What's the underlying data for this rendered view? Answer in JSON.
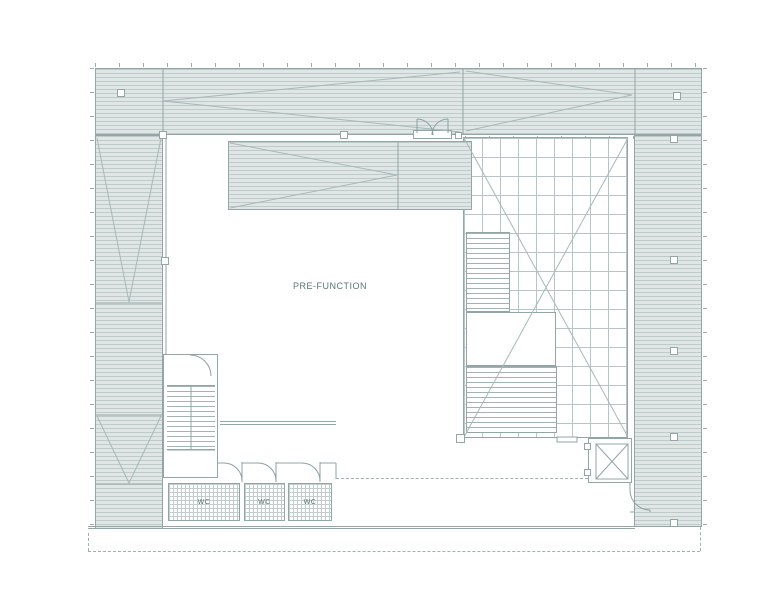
{
  "plan": {
    "type": "architectural-floor-plan",
    "labels": {
      "prefunction": "PRE-FUNCTION",
      "wc": [
        "WC",
        "WC",
        "WC"
      ]
    },
    "colors": {
      "background": "#ffffff",
      "hatch_fill": "#e0e6e6",
      "hatch_line": "#bfcaca",
      "wall_outline": "#93a5a5",
      "grid_line": "#b9c5c5",
      "decor_line": "#a8b8b8",
      "dashed_line": "#9fb0b0",
      "label_text": "#5b7474"
    }
  }
}
